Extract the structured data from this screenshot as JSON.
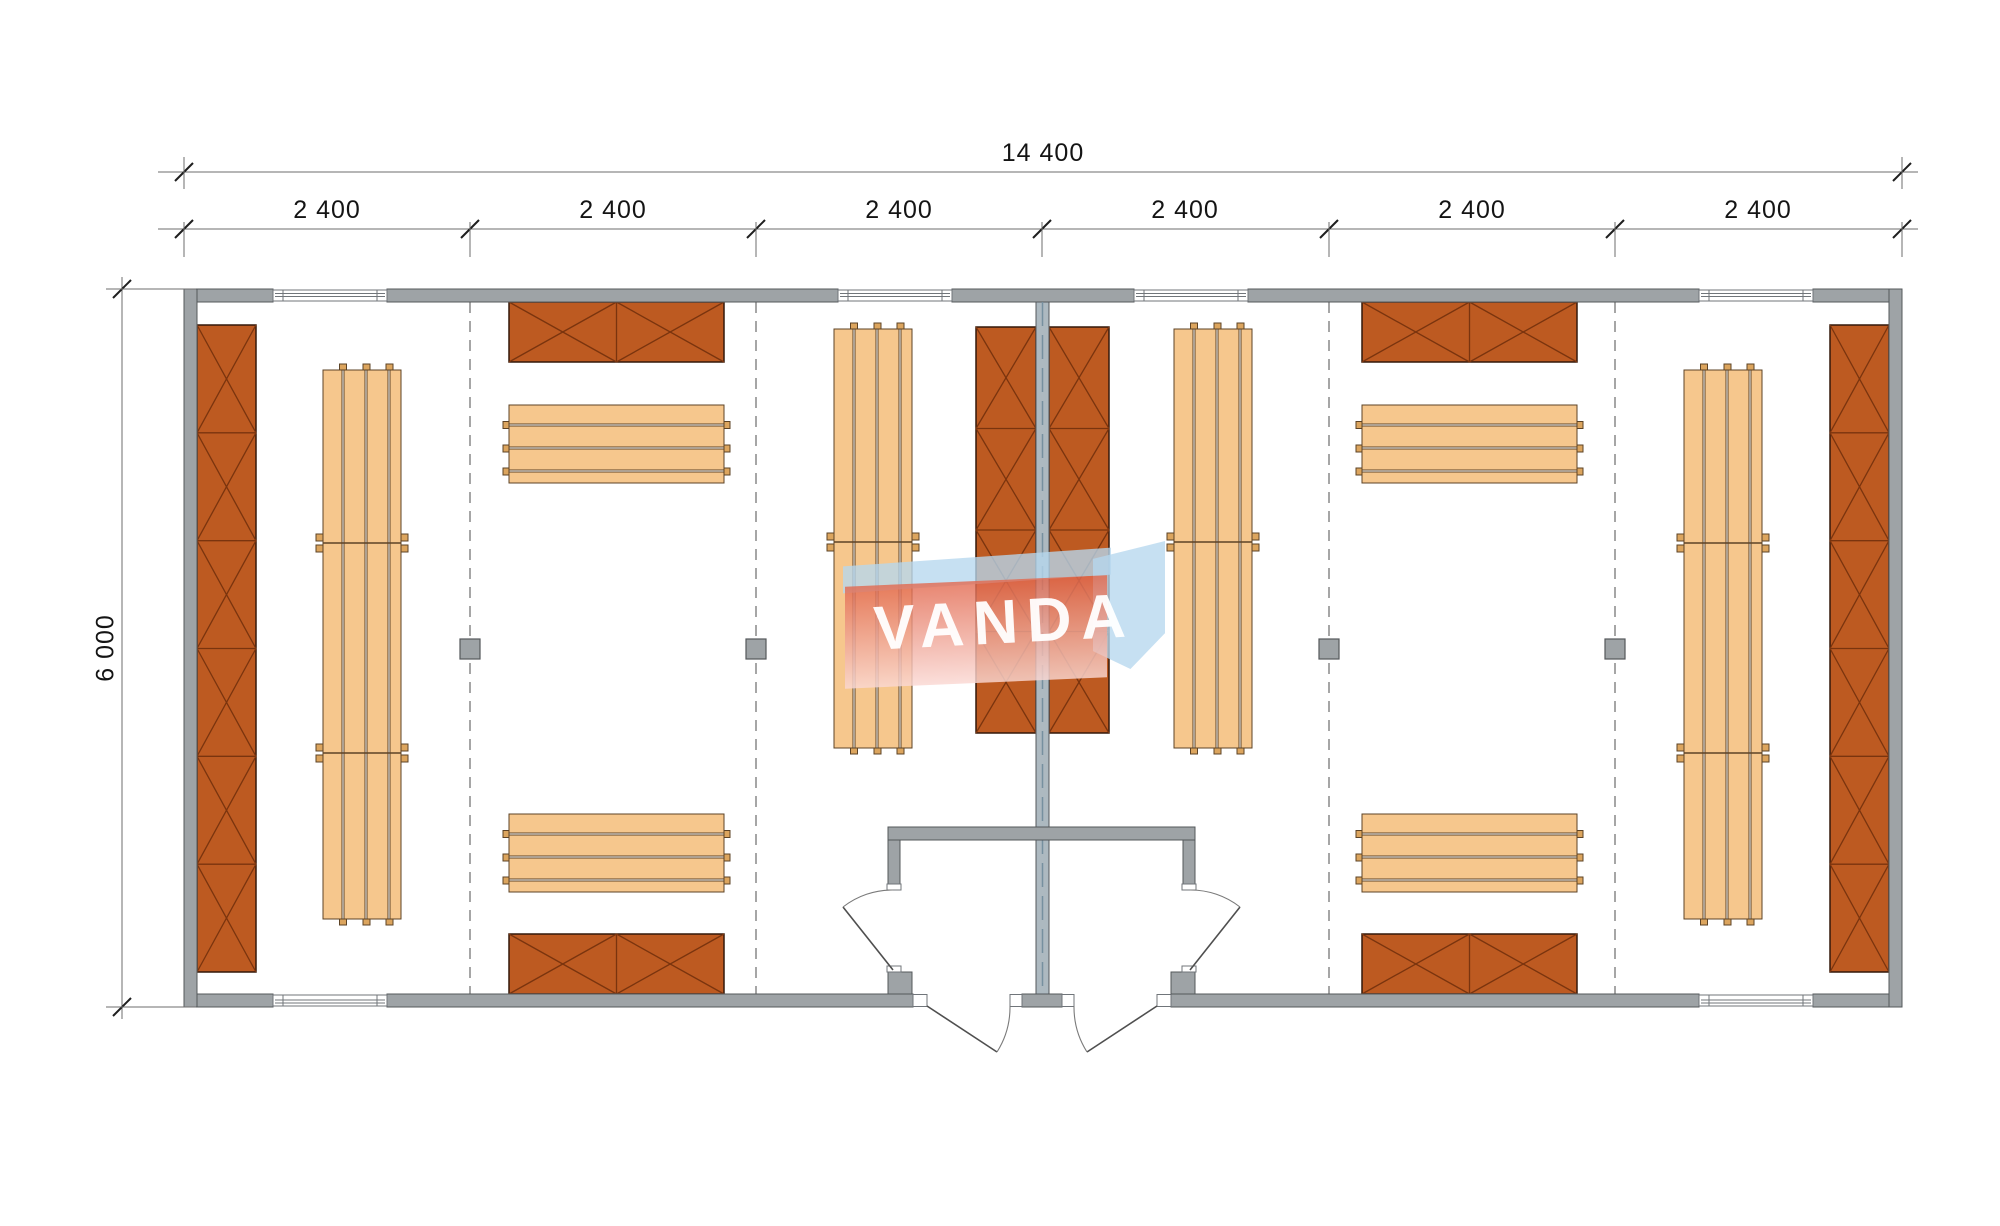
{
  "drawing": {
    "kind": "architectural floor plan, top view",
    "description": "rectangular modular building of six bays with central partition, wardrobe cabinets (crossed boxes), slatted benches, four structural posts, six windows, double central entrance with vestibules"
  },
  "dimensions": {
    "overall_width_label": "14 400",
    "overall_height_label": "6 000",
    "module_labels": [
      "2 400",
      "2 400",
      "2 400",
      "2 400",
      "2 400",
      "2 400"
    ]
  },
  "watermark": {
    "text": "VANDA"
  },
  "counts": {
    "windows_top": 4,
    "windows_bottom": 2,
    "entrance_doors": 2,
    "interior_doors": 2,
    "structural_posts": 4,
    "cross_box_cabinets": 8,
    "slatted_benches": 8,
    "module_divider_lines": 4
  },
  "colors": {
    "background": "#ffffff",
    "wall_fill": "#9ea3a6",
    "wall_stroke": "#54585b",
    "partition_fill": "#adb9c0",
    "partition_axis": "#76909f",
    "locker_fill": "#bd5a21",
    "locker_cross": "#7a340e",
    "locker_stroke": "#33180a",
    "bench_fill": "#f6c78d",
    "bench_stroke": "#5d4326",
    "tab_fill": "#dca55e",
    "divider_dash": "#a6a6a6",
    "window_fill": "#ffffff",
    "window_stroke": "#70757a",
    "door_leaf": "#4f4f4f",
    "door_arc": "#7a7a7a",
    "dim_line": "#6e6e6e",
    "dim_tick": "#1f1f1f",
    "dim_text": "#141414"
  }
}
